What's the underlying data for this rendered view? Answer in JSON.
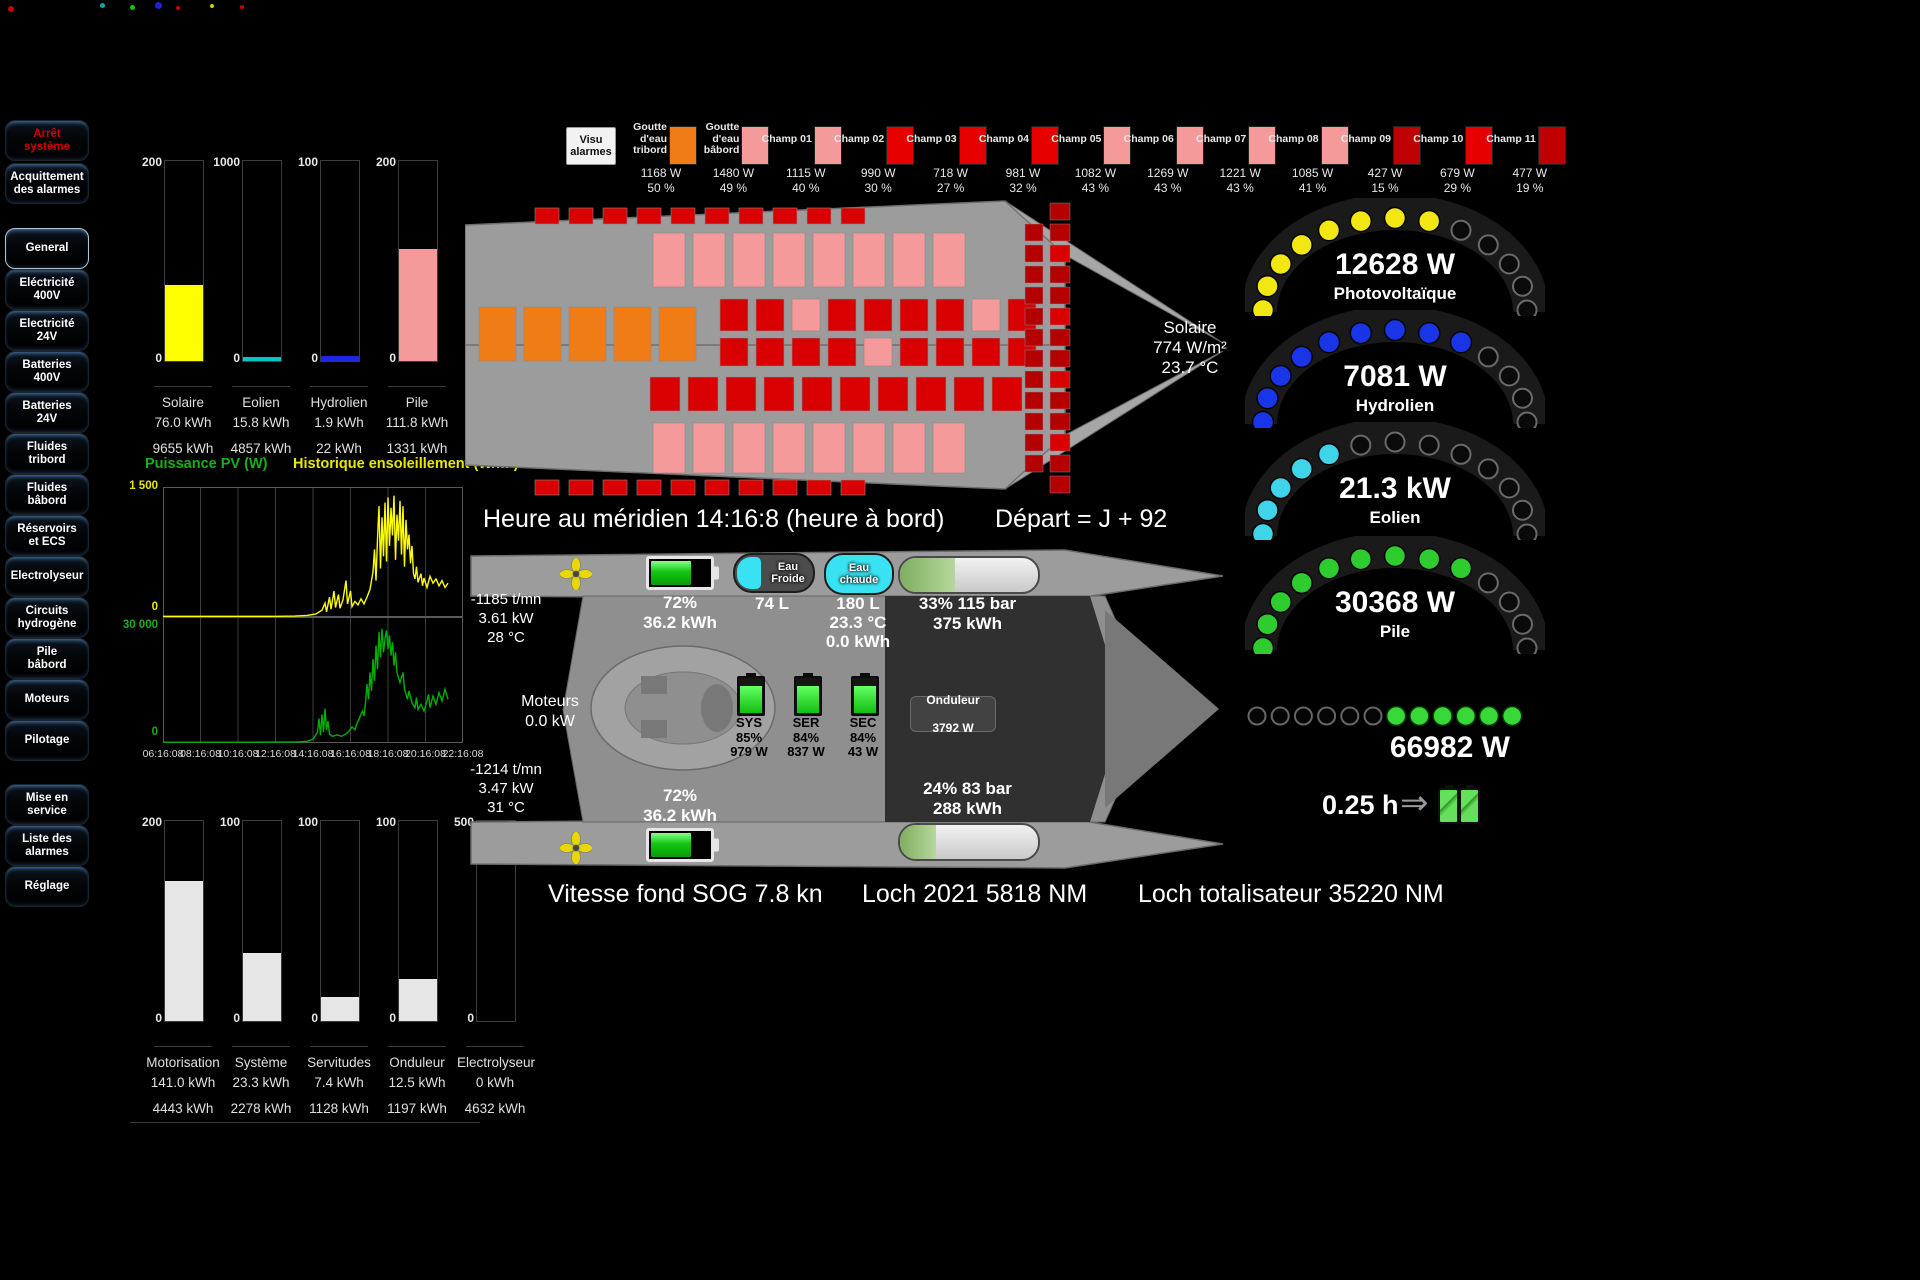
{
  "sidebar": {
    "top_buttons": [
      {
        "id": "arret-systeme",
        "label": "Arrêt\nsystème",
        "red": true
      },
      {
        "id": "acquittement-alarmes",
        "label": "Acquittement\ndes alarmes",
        "red": false
      }
    ],
    "nav_buttons": [
      {
        "id": "general",
        "label": "General",
        "active": true
      },
      {
        "id": "electricite-400v",
        "label": "Eléctricité\n400V"
      },
      {
        "id": "electricite-24v",
        "label": "Electricité\n24V"
      },
      {
        "id": "batteries-400v",
        "label": "Batteries\n400V"
      },
      {
        "id": "batteries-24v",
        "label": "Batteries\n24V"
      },
      {
        "id": "fluides-tribord",
        "label": "Fluides\ntribord"
      },
      {
        "id": "fluides-babord",
        "label": "Fluides\nbâbord"
      },
      {
        "id": "reservoirs-ecs",
        "label": "Réservoirs\net ECS"
      },
      {
        "id": "electrolyseur",
        "label": "Electrolyseur"
      },
      {
        "id": "circuits-hydrogene",
        "label": "Circuits\nhydrogène"
      },
      {
        "id": "pile-babord",
        "label": "Pile\nbâbord"
      },
      {
        "id": "moteurs",
        "label": "Moteurs"
      },
      {
        "id": "pilotage",
        "label": "Pilotage"
      }
    ],
    "bottom_buttons": [
      {
        "id": "mise-en-service",
        "label": "Mise en\nservice"
      },
      {
        "id": "liste-des-alarmes",
        "label": "Liste des\nalarmes"
      },
      {
        "id": "reglage",
        "label": "Réglage"
      }
    ]
  },
  "production_bars": {
    "items": [
      {
        "name": "Solaire",
        "day": "76.0 kWh",
        "total": "9655 kWh",
        "scale": "200",
        "fill_pct": 38,
        "color": "#ffff00"
      },
      {
        "name": "Eolien",
        "day": "15.8 kWh",
        "total": "4857 kWh",
        "scale": "1000",
        "fill_pct": 2,
        "color": "#00c8be"
      },
      {
        "name": "Hydrolien",
        "day": "1.9 kWh",
        "total": "22 kWh",
        "scale": "100",
        "fill_pct": 2.5,
        "color": "#1a28e0"
      },
      {
        "name": "Pile",
        "day": "111.8 kWh",
        "total": "1331 kWh",
        "scale": "200",
        "fill_pct": 56,
        "color": "#f59a9a"
      }
    ]
  },
  "consumption_bars": {
    "items": [
      {
        "name": "Motorisation",
        "day": "141.0 kWh",
        "total": "4443 kWh",
        "scale": "200",
        "fill_pct": 70,
        "color": "#e6e6e6"
      },
      {
        "name": "Système",
        "day": "23.3 kWh",
        "total": "2278 kWh",
        "scale": "100",
        "fill_pct": 34,
        "color": "#e6e6e6"
      },
      {
        "name": "Servitudes",
        "day": "7.4 kWh",
        "total": "1128 kWh",
        "scale": "100",
        "fill_pct": 12,
        "color": "#e6e6e6"
      },
      {
        "name": "Onduleur",
        "day": "12.5 kWh",
        "total": "1197 kWh",
        "scale": "100",
        "fill_pct": 21,
        "color": "#e6e6e6"
      },
      {
        "name": "Electrolyseur",
        "day": "0 kWh",
        "total": "4632 kWh",
        "scale": "500",
        "fill_pct": 0,
        "color": "#e6e6e6"
      }
    ]
  },
  "pv_history": {
    "title_power": "Puissance PV (W)",
    "title_sun": "Historique ensoleillement (W/m²)",
    "sun_ymax_label": "1 500",
    "sun_ymin_label": "0",
    "pv_ymax_label": "30 000",
    "pv_ymin_label": "0",
    "x_ticks": [
      "06:16:08",
      "08:16:08",
      "10:16:08",
      "12:16:08",
      "14:16:08",
      "16:16:08",
      "18:16:08",
      "20:16:08",
      "22:16:08"
    ]
  },
  "chart_data": [
    {
      "type": "bar",
      "categories": [
        "Solaire",
        "Eolien",
        "Hydrolien",
        "Pile"
      ],
      "values": [
        76.0,
        15.8,
        1.9,
        111.8
      ],
      "totals_kwh": [
        9655,
        4857,
        22,
        1331
      ],
      "scales": [
        200,
        1000,
        100,
        200
      ],
      "ylabel": "kWh",
      "legend_position": "none"
    },
    {
      "type": "line",
      "title": "Historique ensoleillement (W/m²)",
      "ylim": [
        0,
        1500
      ],
      "color": "#ffff00",
      "grid": true,
      "x_ticks": [
        "06:16:08",
        "08:16:08",
        "10:16:08",
        "12:16:08",
        "14:16:08",
        "16:16:08",
        "18:16:08",
        "20:16:08",
        "22:16:08"
      ],
      "points": [
        [
          0,
          8
        ],
        [
          20,
          8
        ],
        [
          38,
          8
        ],
        [
          44,
          10
        ],
        [
          48,
          18
        ],
        [
          51,
          35
        ],
        [
          53,
          80
        ],
        [
          54,
          160
        ],
        [
          54.5,
          60
        ],
        [
          55.5,
          230
        ],
        [
          56,
          90
        ],
        [
          57,
          300
        ],
        [
          57.5,
          110
        ],
        [
          58.5,
          260
        ],
        [
          59,
          100
        ],
        [
          60,
          200
        ],
        [
          61,
          420
        ],
        [
          61.5,
          150
        ],
        [
          62.5,
          300
        ],
        [
          63,
          120
        ],
        [
          64,
          180
        ],
        [
          65,
          140
        ],
        [
          66,
          210
        ],
        [
          67,
          150
        ],
        [
          68,
          230
        ],
        [
          69,
          320
        ],
        [
          70,
          520
        ],
        [
          70.5,
          780
        ],
        [
          71,
          420
        ],
        [
          71.5,
          900
        ],
        [
          72,
          1280
        ],
        [
          72.5,
          560
        ],
        [
          73,
          1150
        ],
        [
          73.5,
          700
        ],
        [
          74,
          1320
        ],
        [
          74.5,
          640
        ],
        [
          75,
          1380
        ],
        [
          75.5,
          820
        ],
        [
          76,
          1260
        ],
        [
          76.5,
          940
        ],
        [
          77,
          1400
        ],
        [
          77.5,
          660
        ],
        [
          78,
          1180
        ],
        [
          78.5,
          880
        ],
        [
          79,
          1340
        ],
        [
          79.5,
          720
        ],
        [
          80,
          1280
        ],
        [
          80.5,
          580
        ],
        [
          81,
          1120
        ],
        [
          81.5,
          780
        ],
        [
          82,
          950
        ],
        [
          82.5,
          620
        ],
        [
          83,
          820
        ],
        [
          83.5,
          500
        ],
        [
          84,
          440
        ],
        [
          84.5,
          580
        ],
        [
          85,
          400
        ],
        [
          86,
          500
        ],
        [
          86.5,
          360
        ],
        [
          87,
          450
        ],
        [
          88,
          340
        ],
        [
          89,
          470
        ],
        [
          90,
          390
        ],
        [
          91,
          440
        ],
        [
          92,
          360
        ],
        [
          93,
          420
        ],
        [
          94,
          340
        ],
        [
          95,
          390
        ]
      ]
    },
    {
      "type": "line",
      "title": "Puissance PV (W)",
      "ylim": [
        0,
        30000
      ],
      "color": "#00b000",
      "grid": true,
      "points": [
        [
          0,
          200
        ],
        [
          30,
          200
        ],
        [
          45,
          250
        ],
        [
          48,
          400
        ],
        [
          50,
          900
        ],
        [
          51.5,
          2600
        ],
        [
          52,
          5800
        ],
        [
          52.5,
          1900
        ],
        [
          53,
          6800
        ],
        [
          53.5,
          2600
        ],
        [
          54,
          8200
        ],
        [
          54.5,
          3100
        ],
        [
          55,
          5200
        ],
        [
          55.5,
          2100
        ],
        [
          56.5,
          1600
        ],
        [
          58,
          1900
        ],
        [
          59.5,
          1600
        ],
        [
          61,
          2200
        ],
        [
          62,
          2800
        ],
        [
          63,
          3800
        ],
        [
          64,
          3200
        ],
        [
          64.5,
          4400
        ],
        [
          65.5,
          6000
        ],
        [
          66.5,
          7600
        ],
        [
          67,
          6400
        ],
        [
          67.5,
          9600
        ],
        [
          68,
          14000
        ],
        [
          68.5,
          10400
        ],
        [
          69,
          16800
        ],
        [
          69.5,
          12400
        ],
        [
          70,
          20000
        ],
        [
          70.5,
          14800
        ],
        [
          71,
          23200
        ],
        [
          71.5,
          17600
        ],
        [
          72,
          26400
        ],
        [
          72.5,
          20400
        ],
        [
          73,
          27200
        ],
        [
          73.5,
          21600
        ],
        [
          74,
          24800
        ],
        [
          74.5,
          26800
        ],
        [
          75,
          22400
        ],
        [
          75.5,
          25600
        ],
        [
          76,
          20800
        ],
        [
          76.5,
          24000
        ],
        [
          77,
          18400
        ],
        [
          77.5,
          21600
        ],
        [
          78,
          16800
        ],
        [
          79,
          14400
        ],
        [
          80,
          16800
        ],
        [
          80.5,
          12800
        ],
        [
          81.5,
          10400
        ],
        [
          82,
          12400
        ],
        [
          83,
          9600
        ],
        [
          84,
          8400
        ],
        [
          84.5,
          10800
        ],
        [
          85,
          8000
        ],
        [
          86,
          9200
        ],
        [
          87,
          7600
        ],
        [
          88,
          10000
        ],
        [
          88.5,
          11600
        ],
        [
          89,
          8400
        ],
        [
          90,
          11200
        ],
        [
          91,
          9200
        ],
        [
          92,
          12000
        ],
        [
          93,
          10000
        ],
        [
          94,
          12800
        ],
        [
          95,
          10400
        ]
      ]
    },
    {
      "type": "bar",
      "categories": [
        "Motorisation",
        "Système",
        "Servitudes",
        "Onduleur",
        "Electrolyseur"
      ],
      "values": [
        141.0,
        23.3,
        7.4,
        12.5,
        0
      ],
      "totals_kwh": [
        4443,
        2278,
        1128,
        1197,
        4632
      ],
      "scales": [
        200,
        100,
        100,
        100,
        500
      ],
      "ylabel": "kWh",
      "legend_position": "none"
    }
  ],
  "header_strip": {
    "visu_button": "Visu\nalarmes",
    "items": [
      {
        "label": "Goutte\nd'eau\ntribord",
        "color": "#f07c18",
        "watts": "1168 W",
        "pct": "50 %"
      },
      {
        "label": "Goutte\nd'eau\nbâbord",
        "color": "#f59a9a",
        "watts": "1480 W",
        "pct": "49 %"
      },
      {
        "label": "Champ 01",
        "color": "#f59a9a",
        "watts": "1115 W",
        "pct": "40 %"
      },
      {
        "label": "Champ 02",
        "color": "#e60000",
        "watts": "990 W",
        "pct": "30 %"
      },
      {
        "label": "Champ 03",
        "color": "#e60000",
        "watts": "718 W",
        "pct": "27 %"
      },
      {
        "label": "Champ 04",
        "color": "#e60000",
        "watts": "981 W",
        "pct": "32 %"
      },
      {
        "label": "Champ 05",
        "color": "#f59a9a",
        "watts": "1082 W",
        "pct": "43 %"
      },
      {
        "label": "Champ 06",
        "color": "#f59a9a",
        "watts": "1269 W",
        "pct": "43 %"
      },
      {
        "label": "Champ 07",
        "color": "#f59a9a",
        "watts": "1221 W",
        "pct": "43 %"
      },
      {
        "label": "Champ 08",
        "color": "#f59a9a",
        "watts": "1085 W",
        "pct": "41 %"
      },
      {
        "label": "Champ 09",
        "color": "#c00000",
        "watts": "427 W",
        "pct": "15 %"
      },
      {
        "label": "Champ 10",
        "color": "#e60000",
        "watts": "679 W",
        "pct": "29 %"
      },
      {
        "label": "Champ 11",
        "color": "#c00000",
        "watts": "477 W",
        "pct": "19 %"
      }
    ]
  },
  "top_boat": {
    "solaire": {
      "title": "Solaire",
      "irradiance": "774 W/m²",
      "temp": "23.7 °C"
    }
  },
  "timeline": {
    "heure": "Heure au méridien 14:16:8 (heure à bord)",
    "depart": "Départ = J + 92"
  },
  "engine_room": {
    "motor_top": {
      "rpm": "-1185 t/mn",
      "power": "3.61 kW",
      "temp": "28 °C"
    },
    "motor_bottom": {
      "rpm": "-1214 t/mn",
      "power": "3.47 kW",
      "temp": "31 °C"
    },
    "batt_top": {
      "pct": "72%",
      "energy": "36.2 kWh",
      "fill": 72
    },
    "batt_bottom": {
      "pct": "72%",
      "energy": "36.2 kWh",
      "fill": 72
    },
    "eau_froide": {
      "label": "Eau\nFroide",
      "volume": "74 L"
    },
    "eau_chaude": {
      "label": "Eau\nchaude",
      "volume": "180 L",
      "temp": "23.3 °C",
      "energy": "0.0 kWh"
    },
    "h2_top": {
      "pct_bar": "33% 115 bar",
      "energy": "375 kWh",
      "fill": 40
    },
    "h2_bottom": {
      "pct_bar": "24% 83 bar",
      "energy": "288 kWh",
      "fill": 26
    },
    "moteurs": {
      "label": "Moteurs",
      "power": "0.0 kW"
    },
    "dc_batts": [
      {
        "name": "SYS",
        "pct": "85%",
        "watts": "979 W",
        "fill": 85
      },
      {
        "name": "SER",
        "pct": "84%",
        "watts": "837 W",
        "fill": 84
      },
      {
        "name": "SEC",
        "pct": "84%",
        "watts": "43 W",
        "fill": 84
      }
    ],
    "onduleur": {
      "label": "Onduleur",
      "watts": "3792 W"
    }
  },
  "status_bar": {
    "sog": "Vitesse fond SOG 7.8 kn",
    "loch": "Loch 2021  5818 NM",
    "loch_total": "Loch  totalisateur 35220 NM"
  },
  "gauges": [
    {
      "name": "photovoltaique",
      "value": "12628 W",
      "label": "Photovoltaïque",
      "color": "#f2e613",
      "segments": 13,
      "lit": 8
    },
    {
      "name": "hydrolien",
      "value": "7081 W",
      "label": "Hydrolien",
      "color": "#1a35e8",
      "segments": 13,
      "lit": 9
    },
    {
      "name": "eolien",
      "value": "21.3 kW",
      "label": "Eolien",
      "color": "#3fd4ea",
      "segments": 13,
      "lit": 5
    },
    {
      "name": "pile",
      "value": "30368 W",
      "label": "Pile",
      "color": "#2ecc2e",
      "segments": 13,
      "lit": 9
    }
  ],
  "total_power": {
    "value": "66982 W",
    "segments": 12,
    "lit": 6,
    "color": "#38d838"
  },
  "autonomy": {
    "value": "0.25 h"
  }
}
